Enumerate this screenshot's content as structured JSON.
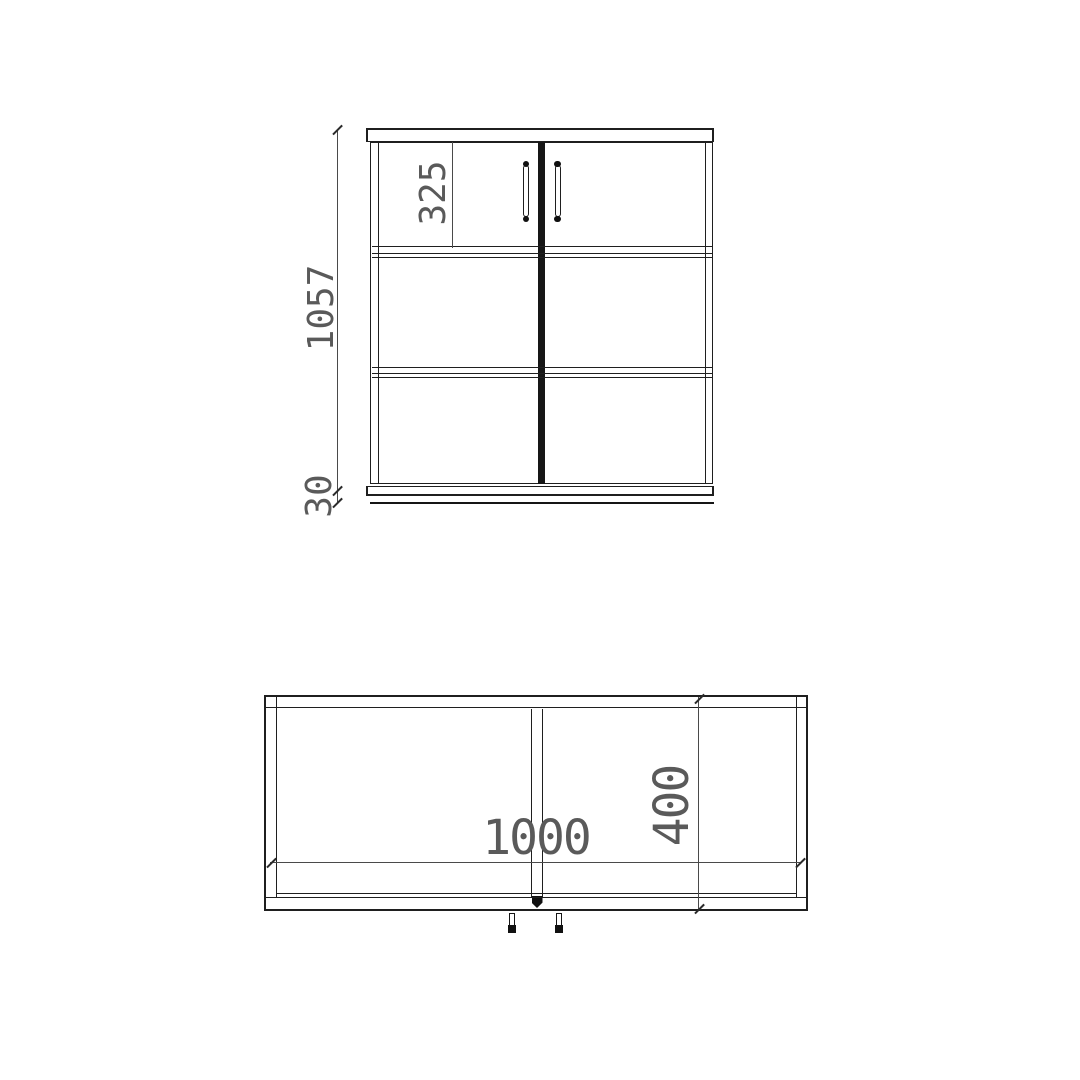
{
  "drawing": {
    "front_view": {
      "dim_height": "1057",
      "dim_top_section": "325",
      "dim_plinth": "30"
    },
    "plan_view": {
      "dim_width": "1000",
      "dim_depth": "400"
    },
    "colors": {
      "line": "#1f1f1f",
      "dim_line": "#4a4a4a",
      "dim_text": "#5a5a5a",
      "background": "#ffffff"
    }
  }
}
